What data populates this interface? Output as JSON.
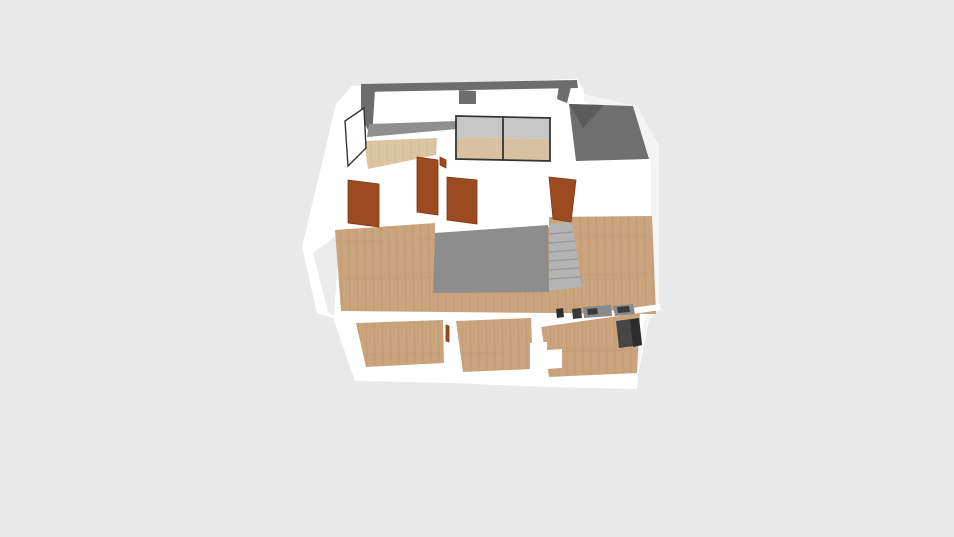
{
  "scene": {
    "title": "3D floor plan isometric render",
    "view": "isometric overview of a single apartment level on a plain light gray canvas (no visible UI chrome)",
    "object_counts": {
      "interior_doors": 4,
      "partial_door_slivers": 2,
      "window_openings_back_wall": 2,
      "side_windows": 1,
      "sliding_glass_doors": 1,
      "staircases": 1,
      "lower_rooms": 3,
      "kitchen_fixture_blocks": 4
    },
    "elements": [
      "back-wall-with-window-openings",
      "left-balcony-wood-floor",
      "side-window",
      "sliding-glass-door",
      "right-balcony-dark-floor",
      "main-hall-wood-floor",
      "central-staircase-enclosure",
      "staircase-steps",
      "interior-doors",
      "lower-left-room",
      "lower-middle-room",
      "kitchen-room",
      "kitchen-appliances"
    ]
  },
  "colors": {
    "background": "#e9e9e9",
    "wall": "#ffffff",
    "wall_recess": "#ebebeb",
    "wall_shade_soft": "#f4f4f4",
    "dark_wall": "#6d6d6d",
    "sill": "#8f8f8f",
    "dark_floor": "#6f6f6f",
    "dark_floor_deep": "#5c5c5c",
    "stair_face": "#8d8d8d",
    "stair_steps": "#b4b4b4",
    "stair_step_line": "#9b9b9b",
    "wood": "#c9a47c",
    "wood_line": "#b28e66",
    "wood_light": "#dcc5a3",
    "wood_light_line": "#ccb189",
    "door": "#9c4a1f",
    "door_edge": "#7c3a16",
    "frame": "#333333",
    "glass_wall": "#c6c6c6",
    "glass_floor": "#d8c1a0",
    "counter": "#8a8a8a",
    "counter_item": "#3a3a3a",
    "appliance": "#454545",
    "appliance_dark": "#2d2d2d"
  }
}
